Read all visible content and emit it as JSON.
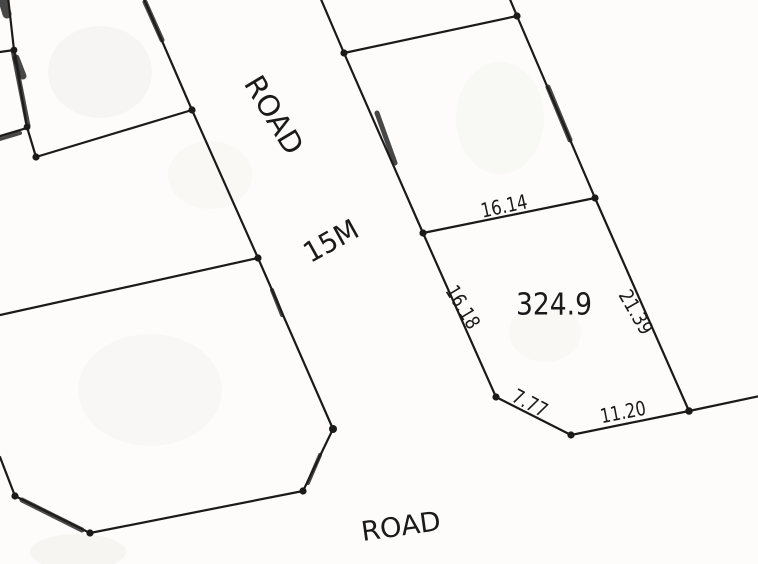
{
  "map": {
    "kind": "cadastral-plot-sketch",
    "labels": {
      "road_vertical": "ROAD",
      "road_width": "15M",
      "road_bottom": "ROAD"
    },
    "parcel": {
      "area": "324.9",
      "dims": {
        "top": "16.14",
        "left": "16.18",
        "right": "21.39",
        "bottom_left": "7.77",
        "bottom_right": "11.20"
      }
    },
    "colors": {
      "ink": "#1a1a1a",
      "paper": "#fdfcfb"
    }
  }
}
